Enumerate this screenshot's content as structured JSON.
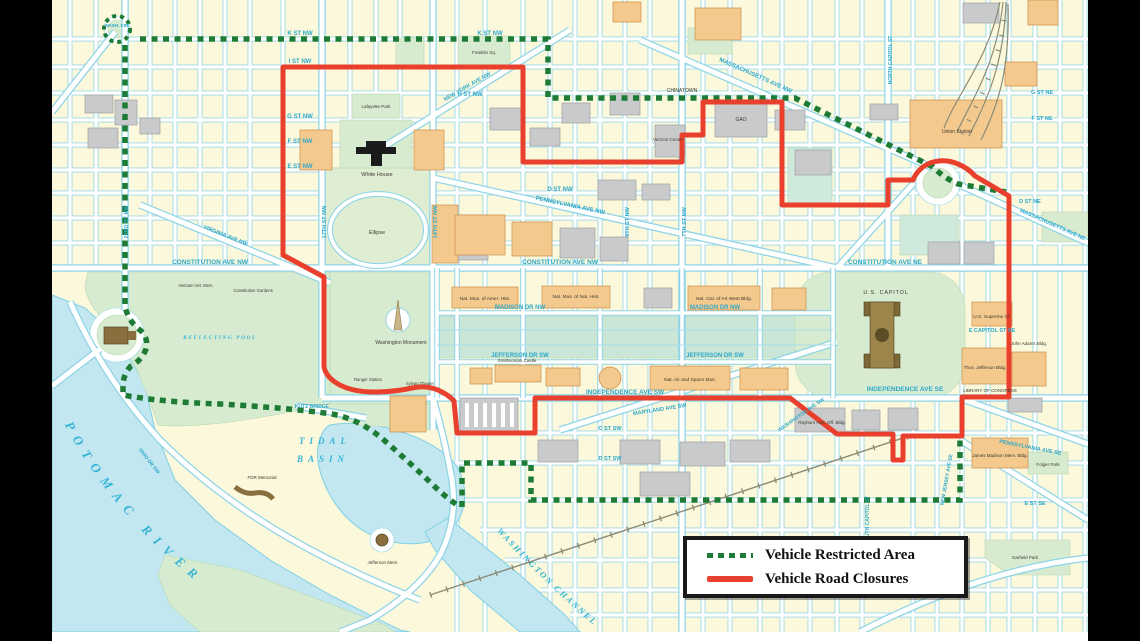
{
  "legend": {
    "items": [
      {
        "label": "Vehicle Restricted Area",
        "swatch": "dashed-green"
      },
      {
        "label": "Vehicle Road Closures",
        "swatch": "solid-red"
      }
    ]
  },
  "colors": {
    "restricted_green": "#1E7B36",
    "closure_red": "#E8402C",
    "water": "#C3E7F1",
    "land": "#FBF8DC",
    "park": "#D7EBD0",
    "building_gray": "#C9CACB",
    "building_orange": "#F4C98E",
    "street_label": "#2FA8C8",
    "legend_border": "#1a1a1a"
  },
  "map": {
    "icons": [
      "white-house-icon",
      "us-capitol-icon",
      "washington-monument-icon",
      "lincoln-memorial-icon",
      "jefferson-memorial-icon",
      "fdr-memorial-icon"
    ],
    "labels": [
      {
        "t": "K ST NW",
        "x": 300,
        "y": 35,
        "s": 6,
        "k": "street"
      },
      {
        "t": "K ST NW",
        "x": 490,
        "y": 35,
        "s": 6,
        "k": "street"
      },
      {
        "t": "I ST NW",
        "x": 300,
        "y": 63,
        "s": 6,
        "k": "street"
      },
      {
        "t": "H ST NW",
        "x": 470,
        "y": 96,
        "s": 6,
        "k": "street"
      },
      {
        "t": "G ST NW",
        "x": 300,
        "y": 118,
        "s": 6,
        "k": "street"
      },
      {
        "t": "F ST NW",
        "x": 300,
        "y": 143,
        "s": 6,
        "k": "street"
      },
      {
        "t": "E ST NW",
        "x": 300,
        "y": 168,
        "s": 6,
        "k": "street"
      },
      {
        "t": "D ST NW",
        "x": 560,
        "y": 191,
        "s": 6,
        "k": "street"
      },
      {
        "t": "CONSTITUTION AVE NW",
        "x": 210,
        "y": 264,
        "s": 6.5,
        "k": "street"
      },
      {
        "t": "CONSTITUTION AVE NW",
        "x": 560,
        "y": 264,
        "s": 6.5,
        "k": "street"
      },
      {
        "t": "CONSTITUTION AVE NE",
        "x": 885,
        "y": 264,
        "s": 6.5,
        "k": "street"
      },
      {
        "t": "MADISON DR NW",
        "x": 520,
        "y": 309,
        "s": 6,
        "k": "street"
      },
      {
        "t": "MADISON DR NW",
        "x": 715,
        "y": 309,
        "s": 6,
        "k": "street"
      },
      {
        "t": "JEFFERSON DR SW",
        "x": 520,
        "y": 357,
        "s": 6,
        "k": "street"
      },
      {
        "t": "JEFFERSON DR SW",
        "x": 715,
        "y": 357,
        "s": 6,
        "k": "street"
      },
      {
        "t": "INDEPENDENCE AVE SW",
        "x": 625,
        "y": 394,
        "s": 6.5,
        "k": "street"
      },
      {
        "t": "INDEPENDENCE AVE SE",
        "x": 905,
        "y": 391,
        "s": 6.5,
        "k": "street"
      },
      {
        "t": "MASSACHUSETTS AVE NW",
        "x": 755,
        "y": 77,
        "s": 6,
        "k": "street",
        "r": 24
      },
      {
        "t": "MASSACHUSETTS AVE NE",
        "x": 1052,
        "y": 226,
        "s": 5.5,
        "k": "street",
        "r": 24
      },
      {
        "t": "PENNSYLVANIA AVE NW",
        "x": 570,
        "y": 207,
        "s": 6,
        "k": "street",
        "r": 12
      },
      {
        "t": "NEW YORK AVE NW",
        "x": 468,
        "y": 88,
        "s": 5.5,
        "k": "street",
        "r": -30
      },
      {
        "t": "VIRGINIA AVE NW",
        "x": 225,
        "y": 237,
        "s": 5.5,
        "k": "street",
        "r": 22
      },
      {
        "t": "MARYLAND AVE SW",
        "x": 660,
        "y": 411,
        "s": 5.5,
        "k": "street",
        "r": -9
      },
      {
        "t": "E CAPITOL ST SE",
        "x": 992,
        "y": 332,
        "s": 5.5,
        "k": "street"
      },
      {
        "t": "KUTZ BRIDGE",
        "x": 312,
        "y": 408,
        "s": 5,
        "k": "street"
      },
      {
        "t": "23RD ST NW",
        "x": 128,
        "y": 222,
        "s": 5.5,
        "k": "street",
        "r": -90
      },
      {
        "t": "17TH ST NW",
        "x": 326,
        "y": 222,
        "s": 5.5,
        "k": "street",
        "r": -90
      },
      {
        "t": "14TH ST NW",
        "x": 437,
        "y": 222,
        "s": 5.5,
        "k": "street",
        "r": -90
      },
      {
        "t": "9TH ST NW",
        "x": 629,
        "y": 222,
        "s": 5.5,
        "k": "street",
        "r": -90
      },
      {
        "t": "7TH ST NW",
        "x": 686,
        "y": 222,
        "s": 5.5,
        "k": "street",
        "r": -90
      },
      {
        "t": "NORTH CAPITOL ST",
        "x": 892,
        "y": 60,
        "s": 5,
        "k": "street",
        "r": -90
      },
      {
        "t": "SOUTH CAPITOL ST",
        "x": 869,
        "y": 520,
        "s": 5,
        "k": "street",
        "r": -90
      },
      {
        "t": "C ST SW",
        "x": 610,
        "y": 430,
        "s": 5.5,
        "k": "street"
      },
      {
        "t": "D ST SW",
        "x": 610,
        "y": 460,
        "s": 5.5,
        "k": "street"
      },
      {
        "t": "D ST NE",
        "x": 1030,
        "y": 203,
        "s": 5.5,
        "k": "street"
      },
      {
        "t": "F ST NE",
        "x": 1042,
        "y": 120,
        "s": 5.5,
        "k": "street"
      },
      {
        "t": "G ST NE",
        "x": 1042,
        "y": 94,
        "s": 5.5,
        "k": "street"
      },
      {
        "t": "E ST SE",
        "x": 1035,
        "y": 505,
        "s": 5.5,
        "k": "street"
      },
      {
        "t": "WASHINGTON AVE SW",
        "x": 802,
        "y": 416,
        "s": 5,
        "k": "street",
        "r": -35
      },
      {
        "t": "OHIO DR SW",
        "x": 148,
        "y": 462,
        "s": 5,
        "k": "street",
        "r": 52
      },
      {
        "t": "PENNSYLVANIA AVE SE",
        "x": 1030,
        "y": 449,
        "s": 5.5,
        "k": "street",
        "r": 11
      },
      {
        "t": "NEW JERSEY AVE SE",
        "x": 948,
        "y": 480,
        "s": 5,
        "k": "street",
        "r": -80
      },
      {
        "t": "WASH. CIR.",
        "x": 117,
        "y": 27,
        "s": 4.5,
        "k": "street"
      },
      {
        "t": "TIDAL",
        "x": 325,
        "y": 444,
        "s": 9,
        "k": "water",
        "sp": 5
      },
      {
        "t": "BASIN",
        "x": 323,
        "y": 462,
        "s": 9,
        "k": "water",
        "sp": 5
      },
      {
        "t": "REFLECTING POOL",
        "x": 220,
        "y": 339,
        "s": 5.5,
        "k": "water",
        "sp": 1.5
      },
      {
        "t": "POTOMAC RIVER",
        "p": "potomac-path",
        "s": 13,
        "k": "water",
        "sp": 8
      },
      {
        "t": "WASHINGTON CHANNEL",
        "p": "channel-path",
        "s": 8.5,
        "k": "water",
        "sp": 2
      },
      {
        "t": "White House",
        "x": 377,
        "y": 176,
        "s": 5.5,
        "k": "dark"
      },
      {
        "t": "Ellipse",
        "x": 377,
        "y": 234,
        "s": 5.5,
        "k": "dark"
      },
      {
        "t": "Washington Monument",
        "x": 401,
        "y": 344,
        "s": 5,
        "k": "dark"
      },
      {
        "t": "U.S. CAPITOL",
        "x": 886,
        "y": 294,
        "s": 5.5,
        "k": "dark",
        "sp": 0.8
      },
      {
        "t": "Union Station",
        "x": 957,
        "y": 133,
        "s": 5,
        "k": "dark"
      },
      {
        "t": "U.S. Supreme Ct.",
        "x": 992,
        "y": 318,
        "s": 4.8,
        "k": "dark"
      },
      {
        "t": "Thos. Jefferson Bldg.",
        "x": 985,
        "y": 369,
        "s": 4.5,
        "k": "dark"
      },
      {
        "t": "John Adams Bldg.",
        "x": 1029,
        "y": 345,
        "s": 4.5,
        "k": "dark"
      },
      {
        "t": "LIBRARY OF CONGRESS",
        "x": 990,
        "y": 392,
        "s": 4.5,
        "k": "dark"
      },
      {
        "t": "James Madison Mem. Bldg.",
        "x": 1000,
        "y": 457,
        "s": 4.5,
        "k": "dark"
      },
      {
        "t": "Rayburn Hse. Off. Bldg.",
        "x": 822,
        "y": 424,
        "s": 4.5,
        "k": "dark"
      },
      {
        "t": "Smithsonian Castle",
        "x": 517,
        "y": 362,
        "s": 4.5,
        "k": "dark"
      },
      {
        "t": "Nat. Air and Space Mus.",
        "x": 690,
        "y": 381,
        "s": 4.8,
        "k": "dark"
      },
      {
        "t": "Nat. Mus. of Amer. Hist.",
        "x": 485,
        "y": 300,
        "s": 4.8,
        "k": "dark"
      },
      {
        "t": "Nat. Mus. of Nat. Hist.",
        "x": 576,
        "y": 298,
        "s": 4.8,
        "k": "dark"
      },
      {
        "t": "Nat. Gal. of Art West Bldg.",
        "x": 724,
        "y": 300,
        "s": 4.8,
        "k": "dark"
      },
      {
        "t": "GAO",
        "x": 741,
        "y": 121,
        "s": 5,
        "k": "dark"
      },
      {
        "t": "Verizon Center",
        "x": 668,
        "y": 141,
        "s": 4.5,
        "k": "dark"
      },
      {
        "t": "Franklin Sq.",
        "x": 484,
        "y": 54,
        "s": 4.5,
        "k": "dark"
      },
      {
        "t": "Lafayette Park",
        "x": 376,
        "y": 108,
        "s": 4.5,
        "k": "dark"
      },
      {
        "t": "Jefferson Mem.",
        "x": 383,
        "y": 564,
        "s": 4.5,
        "k": "dark"
      },
      {
        "t": "FDR Memorial",
        "x": 262,
        "y": 479,
        "s": 4.5,
        "k": "dark"
      },
      {
        "t": "Folger Park",
        "x": 1048,
        "y": 466,
        "s": 4.5,
        "k": "dark"
      },
      {
        "t": "Garfield Park",
        "x": 1025,
        "y": 559,
        "s": 4.5,
        "k": "dark"
      },
      {
        "t": "CHINATOWN",
        "x": 682,
        "y": 92,
        "s": 5,
        "k": "dark"
      },
      {
        "t": "Constitution Gardens",
        "x": 253,
        "y": 292,
        "s": 4.2,
        "k": "dark"
      },
      {
        "t": "Vietnam Vet. Mem.",
        "x": 196,
        "y": 287,
        "s": 4.2,
        "k": "dark"
      },
      {
        "t": "Ranger Station",
        "x": 368,
        "y": 381,
        "s": 4.2,
        "k": "dark"
      },
      {
        "t": "Sylvan Theater",
        "x": 420,
        "y": 385,
        "s": 4.2,
        "k": "dark"
      }
    ]
  }
}
